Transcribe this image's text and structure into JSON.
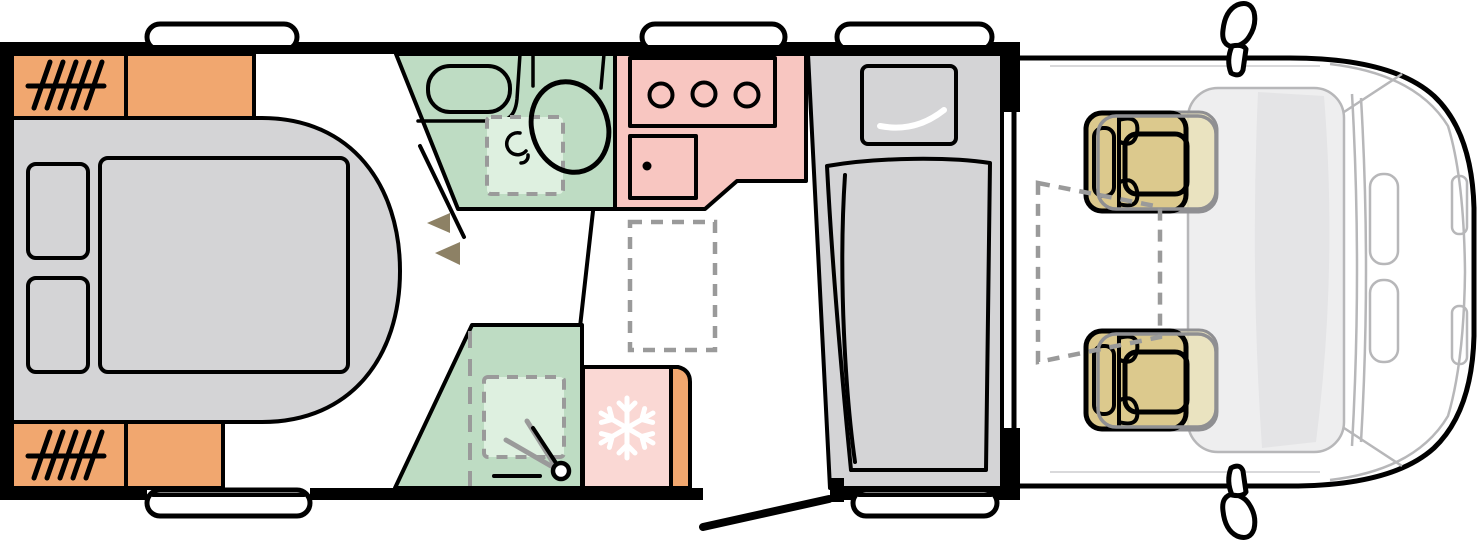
{
  "diagram": {
    "type": "motorhome-floorplan-top-view",
    "vehicle_front_side": "right",
    "window_count": 5,
    "hob_burner_count": 3,
    "cab_swivel_seat_count": 2,
    "zones": [
      {
        "name": "bedroom",
        "features": [
          "island-bed",
          "mattress",
          "pillow-left",
          "pillow-right",
          "wardrobe-top",
          "wardrobe-bottom"
        ]
      },
      {
        "name": "bathroom",
        "features": [
          "washbasin",
          "toilet",
          "folding-tray-dashed",
          "tap-icon",
          "door-swing-line",
          "door-swing-arrows"
        ]
      },
      {
        "name": "kitchen",
        "features": [
          "hob-3-burners",
          "sink-with-drain"
        ]
      },
      {
        "name": "hallway",
        "features": [
          "optional-furniture-dashed"
        ]
      },
      {
        "name": "shower-room",
        "features": [
          "shower-tray-dashed",
          "shower-head-icon",
          "folding-door-dashed"
        ]
      },
      {
        "name": "fridge",
        "features": [
          "snowflake-icon",
          "side-cabinet"
        ]
      },
      {
        "name": "lounge-bench",
        "features": [
          "cushion",
          "bench-seat",
          "window"
        ]
      },
      {
        "name": "entry-door",
        "features": [
          "open-door-line",
          "threshold-step"
        ]
      },
      {
        "name": "cab",
        "features": [
          "driver-swivel-seat",
          "passenger-swivel-seat",
          "table-zone-dashed",
          "windshield",
          "wing-mirror-top",
          "wing-mirror-bottom"
        ]
      }
    ],
    "colors": {
      "wall": "#000000",
      "storage": "#f1a76f",
      "bathroom": "#bedcc3",
      "shower_tray": "#def0e0",
      "kitchen": "#f8c6c1",
      "fridge": "#fad8d4",
      "furniture": "#d4d4d6",
      "seat": "#dcc98d",
      "seat_ghost": "#e9e0b4",
      "arrow": "#8d8165",
      "dash": "#9a9a9a",
      "cab_line": "#b7b7b9",
      "cab_glass": "#eeeeef",
      "glass_shade": "#e4e4e6",
      "highlight": "#ffffff"
    }
  }
}
